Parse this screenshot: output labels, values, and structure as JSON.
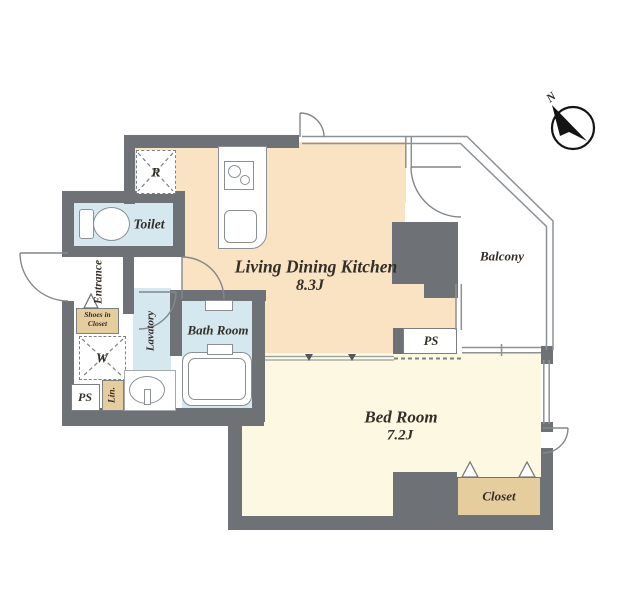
{
  "plan": {
    "title": "apartment-floor-plan",
    "rooms": {
      "ldk": {
        "name": "Living Dining Kitchen",
        "area": "8.3J"
      },
      "bedroom": {
        "name": "Bed Room",
        "area": "7.2J"
      },
      "toilet": {
        "name": "Toilet"
      },
      "bath": {
        "name": "Bath Room"
      },
      "lavatory": {
        "name": "Lavatory"
      },
      "entrance": {
        "name": "Entrance"
      },
      "balcony": {
        "name": "Balcony"
      },
      "closet": {
        "name": "Closet"
      }
    },
    "fixtures": {
      "refrigerator_mark": "R",
      "washer_mark": "W",
      "linen_mark": "Lin.",
      "pipe_space_left": "PS",
      "pipe_space_balcony": "PS",
      "shoe_closet_line1": "Shoes in",
      "shoe_closet_line2": "Closet"
    },
    "compass": {
      "north_mark": "N"
    },
    "colors": {
      "wall": "#6e7276",
      "ldk_floor": "#f9e3c3",
      "bedroom_floor": "#fcf8e1",
      "wet_room_floor": "#d5e7ef",
      "closet_tan": "#e6cd9d",
      "line_gray": "#8d9195"
    }
  }
}
